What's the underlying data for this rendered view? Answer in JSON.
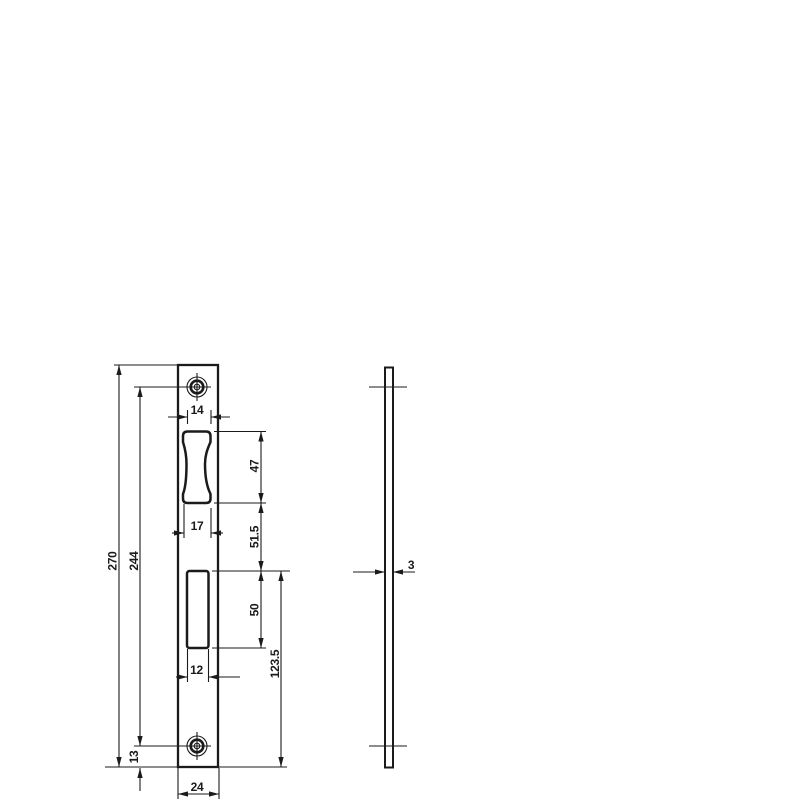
{
  "drawing": {
    "type": "technical-drawing",
    "subject": "strike-plate",
    "background_color": "#ffffff",
    "line_color": "#1b1b1b",
    "front_view": {
      "dims": {
        "overall_height": "270",
        "screw_hole_spacing": "244",
        "bottom_screw_offset": "13",
        "latch_opening_top_width": "14",
        "latch_opening_height": "47",
        "latch_opening_bottom_width": "17",
        "latch_to_deadbolt_gap": "51.5",
        "deadbolt_opening_height": "50",
        "deadbolt_opening_width": "12",
        "deadbolt_top_to_bottom_edge": "123.5",
        "plate_width": "24"
      }
    },
    "side_view": {
      "dims": {
        "thickness": "3"
      }
    }
  }
}
